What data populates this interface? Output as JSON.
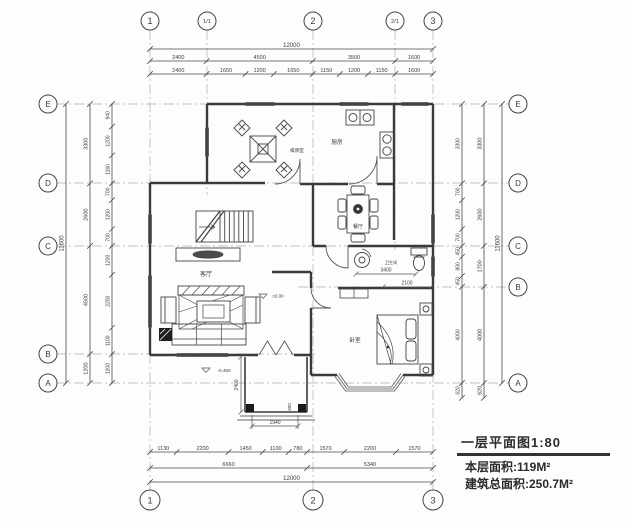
{
  "axes": {
    "top": [
      "1",
      "1/1",
      "2",
      "2/1",
      "3"
    ],
    "bottom": [
      "1",
      "2",
      "3"
    ],
    "left": [
      "E",
      "D",
      "C",
      "B",
      "A"
    ],
    "right": [
      "E",
      "D",
      "C",
      "B",
      "A"
    ]
  },
  "dims": {
    "top_total": [
      "12000"
    ],
    "top_major": [
      "2400",
      "4500",
      "3500",
      "1600"
    ],
    "top_minor": [
      "2400",
      "1650",
      "1200",
      "1650",
      "1150",
      "1200",
      "1150",
      "1600"
    ],
    "bottom_minor": [
      "1130",
      "2200",
      "1450",
      "1100",
      "780",
      "1570",
      "2200",
      "1570"
    ],
    "bottom_major": [
      "6660",
      "5340"
    ],
    "bottom_total": [
      "12000"
    ],
    "left_total": [
      "11600"
    ],
    "left_major": [
      "3300",
      "2600",
      "4500",
      "1200"
    ],
    "left_minor": [
      "940",
      "1200",
      "1160",
      "700",
      "1200",
      "700",
      "1200",
      "2200",
      "1100",
      "1200"
    ],
    "right_total": [
      "11600"
    ],
    "right_major": [
      "3300",
      "2600",
      "1700",
      "4000",
      "620"
    ],
    "right_minor": [
      "3300",
      "700",
      "1200",
      "700",
      "450",
      "800",
      "450",
      "4000",
      "620"
    ],
    "interior": {
      "bath_w": "3400",
      "bath_d": "2100",
      "porch_h": "2400",
      "porch_w": "1940",
      "step": "300",
      "level_in": "±0.00",
      "level_out": "-0.450"
    }
  },
  "rooms": {
    "chess": "棋牌室",
    "kitchen": "厨房",
    "dining": "餐厅",
    "living": "客厅",
    "bath": "卫生间",
    "bedroom": "卧室"
  },
  "titleblock": {
    "title": "一层平面图1:80",
    "floor_area": "本层面积:119M²",
    "total_area": "建筑总面积:250.7M²"
  },
  "colors": {
    "wall": "#3a3a3a",
    "thin": "#555555",
    "text": "#3b3b3b",
    "axis": "#9a9a9a",
    "bg": "#fdfdfd"
  }
}
